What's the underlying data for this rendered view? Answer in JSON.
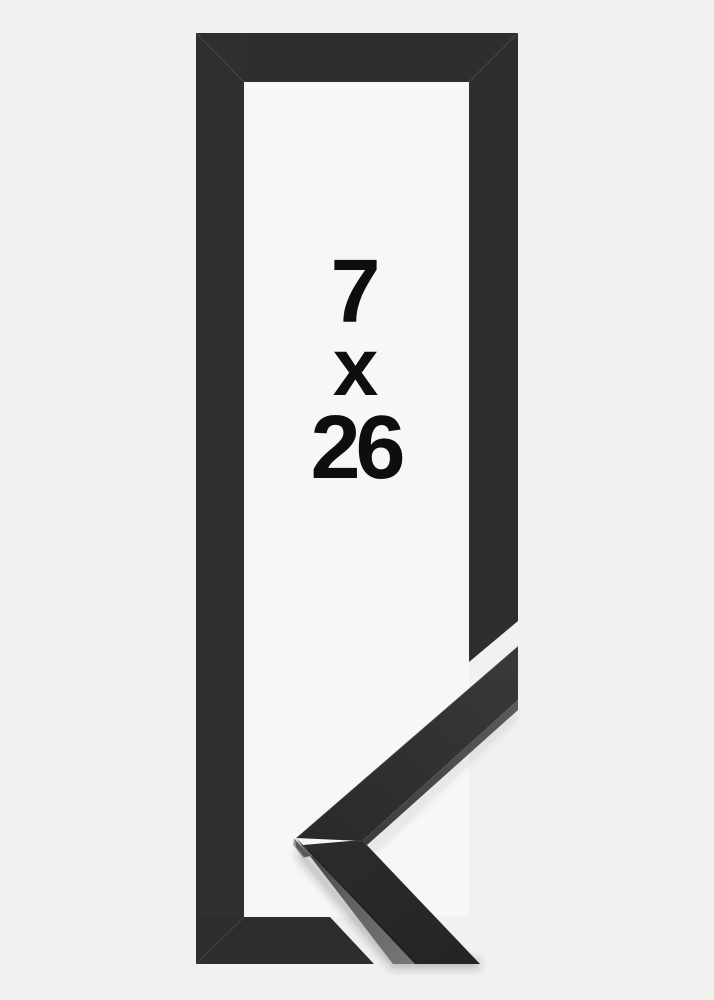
{
  "product_image": {
    "description": "picture frame product photo with enlarged corner sample",
    "size_label": {
      "width": "7",
      "separator": "x",
      "height": "26"
    },
    "colors": {
      "background": "#f1f1ef",
      "frame_opening": "#f7f7f5",
      "frame_face": "#2e2e30",
      "sample_face_dark": "#29292b",
      "sample_side_face": "#6a6a6d",
      "text": "#0e0e0e"
    }
  }
}
